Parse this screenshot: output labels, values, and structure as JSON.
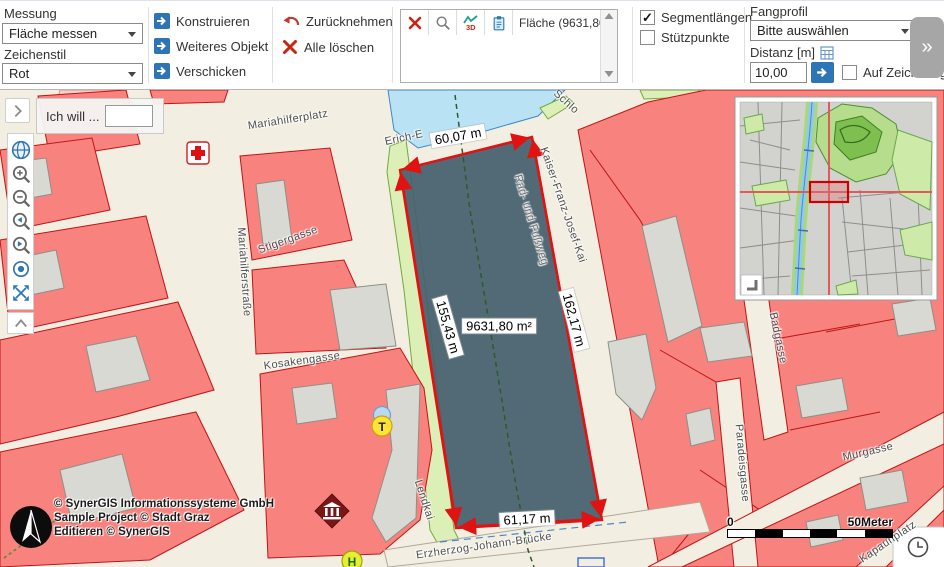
{
  "toolbar": {
    "measurement_label": "Messung",
    "measurement_value": "Fläche messen",
    "style_label": "Zeichenstil",
    "style_value": "Rot",
    "btn_construct": "Konstruieren",
    "btn_next_object": "Weiteres Objekt",
    "btn_send": "Verschicken",
    "btn_undo": "Zurücknehmen",
    "btn_clear_all": "Alle löschen",
    "result_entry": "Fläche (9631,80 m²)",
    "profile3d_label": "3D",
    "chk_segment_label": "Segmentlängen",
    "chk_segment_state": "✓",
    "chk_support_label": "Stützpunkte",
    "chk_support_state": "",
    "snap_label": "Fangprofil",
    "snap_value": "Bitte auswählen",
    "distance_label": "Distanz [m]",
    "distance_value": "10,00",
    "snap_drawing_label": "Auf Zeichnung fang",
    "expand_glyph": "»"
  },
  "map": {
    "search_prompt": "Ich will ...",
    "measure": {
      "top": "60,07 m",
      "left": "155,43 m",
      "right": "162,17 m",
      "bottom": "61,17 m",
      "area": "9631,80 m²"
    },
    "streets": [
      "Mariahilferplatz",
      "Erich-E",
      "Schlo",
      "Stigergasse",
      "Mariahilferstraße",
      "Kosakengasse",
      "Lendkai",
      "Kaiser-Franz-Josef-Kai",
      "Rad- und Fußweg",
      "Erzherzog-Johann-Brücke",
      "Badgasse",
      "Paradeisgasse",
      "Murgasse",
      "Kapaunplatz"
    ],
    "symbols": {
      "taxi": "T",
      "stop": "H"
    },
    "copyright_line1": "© SynerGIS Informationssysteme GmbH",
    "copyright_line2": "Sample Project © Stadt Graz",
    "copyright_line3": "Editieren © SynerGIS",
    "scale_zero": "0",
    "scale_label": "50Meter"
  },
  "colors": {
    "accent_blue": "#2e75b6",
    "measure_red": "#e01212",
    "building_red": "#f8827d",
    "polygon_fill": "#46606e"
  }
}
